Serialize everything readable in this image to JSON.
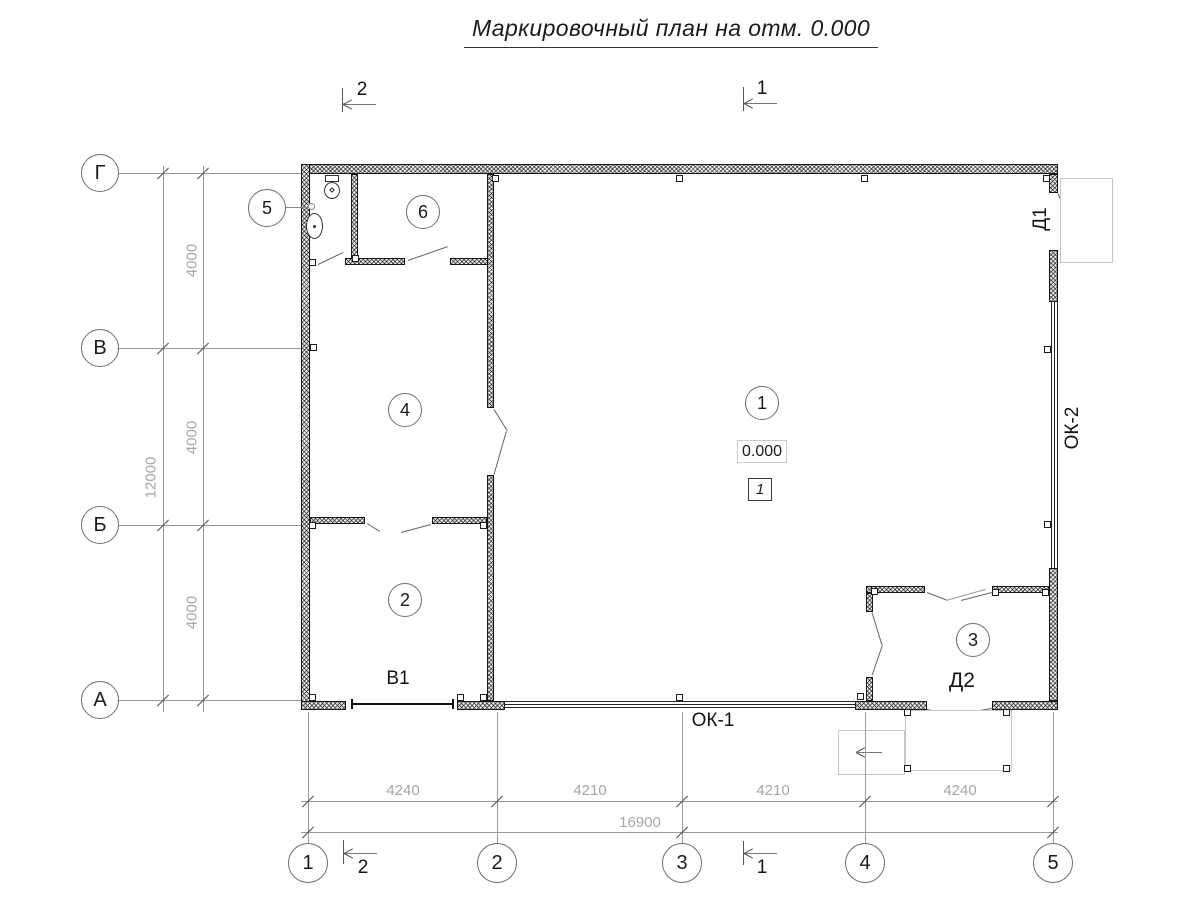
{
  "title": "Маркировочный план на отм. 0.000",
  "axes": {
    "horizontal": [
      "1",
      "2",
      "3",
      "4",
      "5"
    ],
    "vertical": [
      "Г",
      "В",
      "Б",
      "А"
    ]
  },
  "dimensions": {
    "left_total": "12000",
    "left_segments": [
      "4000",
      "4000",
      "4000"
    ],
    "bottom_segments": [
      "4240",
      "4210",
      "4210",
      "4240"
    ],
    "bottom_total": "16900"
  },
  "rooms": [
    "1",
    "2",
    "3",
    "4",
    "5",
    "6"
  ],
  "marks": {
    "door_1": "Д1",
    "door_2": "Д2",
    "gate_1": "В1",
    "window_1": "ОК-1",
    "window_2": "ОК-2",
    "elevation": "0.000",
    "floor_type": "1",
    "section_1": "1",
    "section_2": "2"
  }
}
